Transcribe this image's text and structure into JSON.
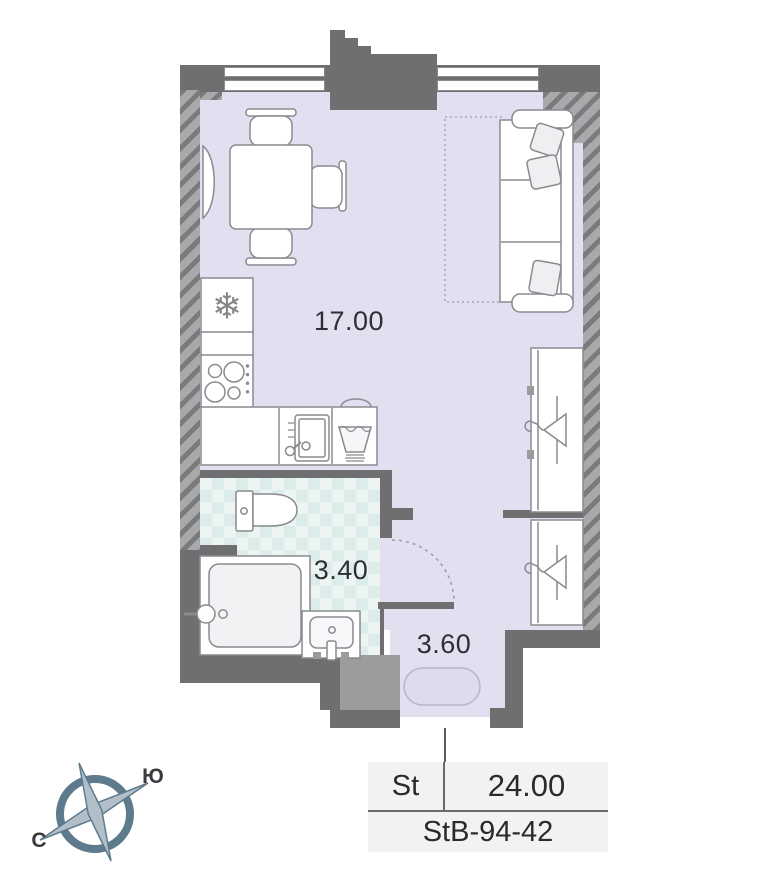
{
  "plan": {
    "areas": [
      {
        "name": "living-kitchen",
        "value": "17.00"
      },
      {
        "name": "bathroom",
        "value": "3.40"
      },
      {
        "name": "hallway",
        "value": "3.60"
      }
    ],
    "compass": {
      "south": "Ю",
      "north": "С"
    },
    "info": {
      "type": "St",
      "area": "24.00",
      "unit": "StB-94-42"
    },
    "icons": {
      "snowflake": "❄"
    },
    "colors": {
      "wall": "#6f6f71",
      "floor_main": "#e2e0f0",
      "floor_bath": "#edf5f3",
      "bath_checker": "#dcecea",
      "furniture_stroke": "#8a8a8f",
      "compass": "#5d7b8d",
      "info_bg": "#f3f2f2"
    }
  }
}
